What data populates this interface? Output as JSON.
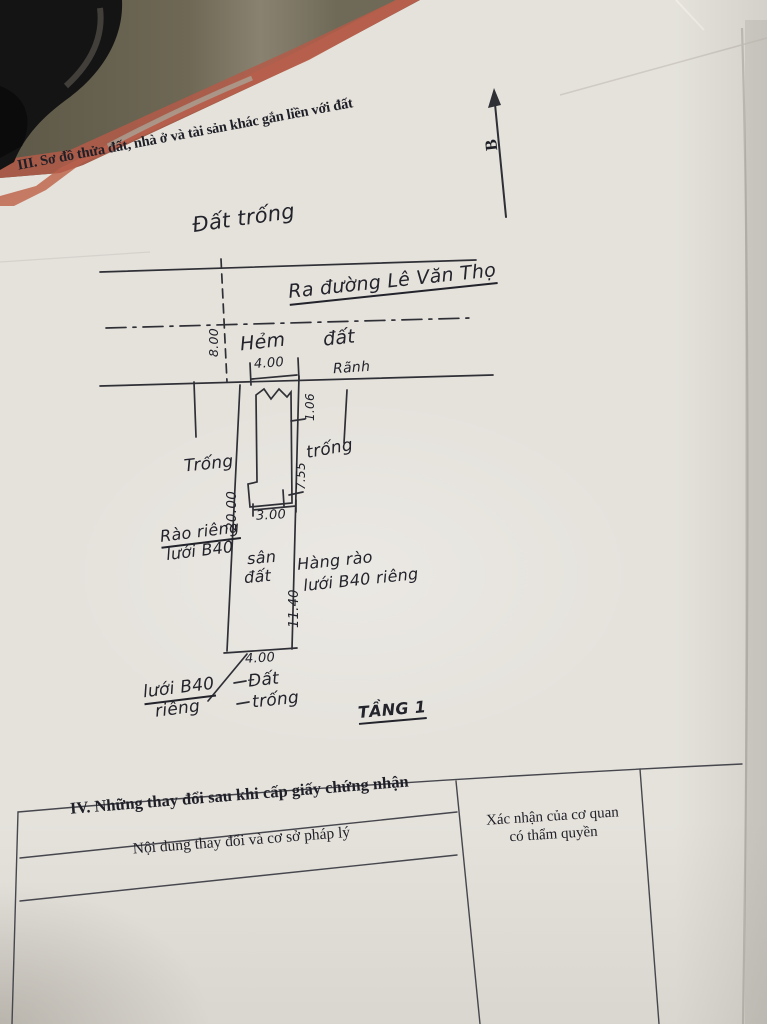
{
  "section_header": "III. Sơ đồ thửa đất, nhà ở và tài sản khác gắn liền với đất",
  "north": {
    "label": "B"
  },
  "sketch": {
    "labels": {
      "dat_trong_top": "Đất trống",
      "ra_duong": "Ra đường Lê Văn Thọ",
      "hem": "Hẻm",
      "dat_alley": "đất",
      "ranh": "Rãnh",
      "trong_left": "Trống",
      "trong_right": "trống",
      "rao_rieng_1": "Rào riêng",
      "rao_rieng_2": "lưới B40",
      "san": "sân",
      "dat_mid": "đất",
      "hang_rao_1": "Hàng rào",
      "hang_rao_2": "lưới B40 riêng",
      "luoi_b40_bot_1": "lưới B40",
      "luoi_b40_bot_2": "riêng",
      "dat_bottom": "Đất",
      "trong_bottom": "trống",
      "tang_1": "TẦNG 1"
    },
    "dims": {
      "front_width": "4.00",
      "alley_width": "8.00",
      "seg_top": "1.06",
      "left_depth": "20.00",
      "seg_mid": "7.55",
      "house_width": "3.00",
      "seg_bottom": "11.40",
      "back_width": "4.00"
    }
  },
  "section_iv": {
    "title": "IV. Những thay đổi sau khi cấp giấy chứng nhận",
    "col_left": "Nội dung thay đổi và cơ sở pháp lý",
    "col_right_1": "Xác nhận của cơ quan",
    "col_right_2": "có thẩm quyền"
  },
  "colors": {
    "paper": "#e5e2dc",
    "ink": "#2f2f36",
    "background_wall": "#67614f",
    "red_edge": "#b35a48",
    "dark_object": "#141414"
  }
}
